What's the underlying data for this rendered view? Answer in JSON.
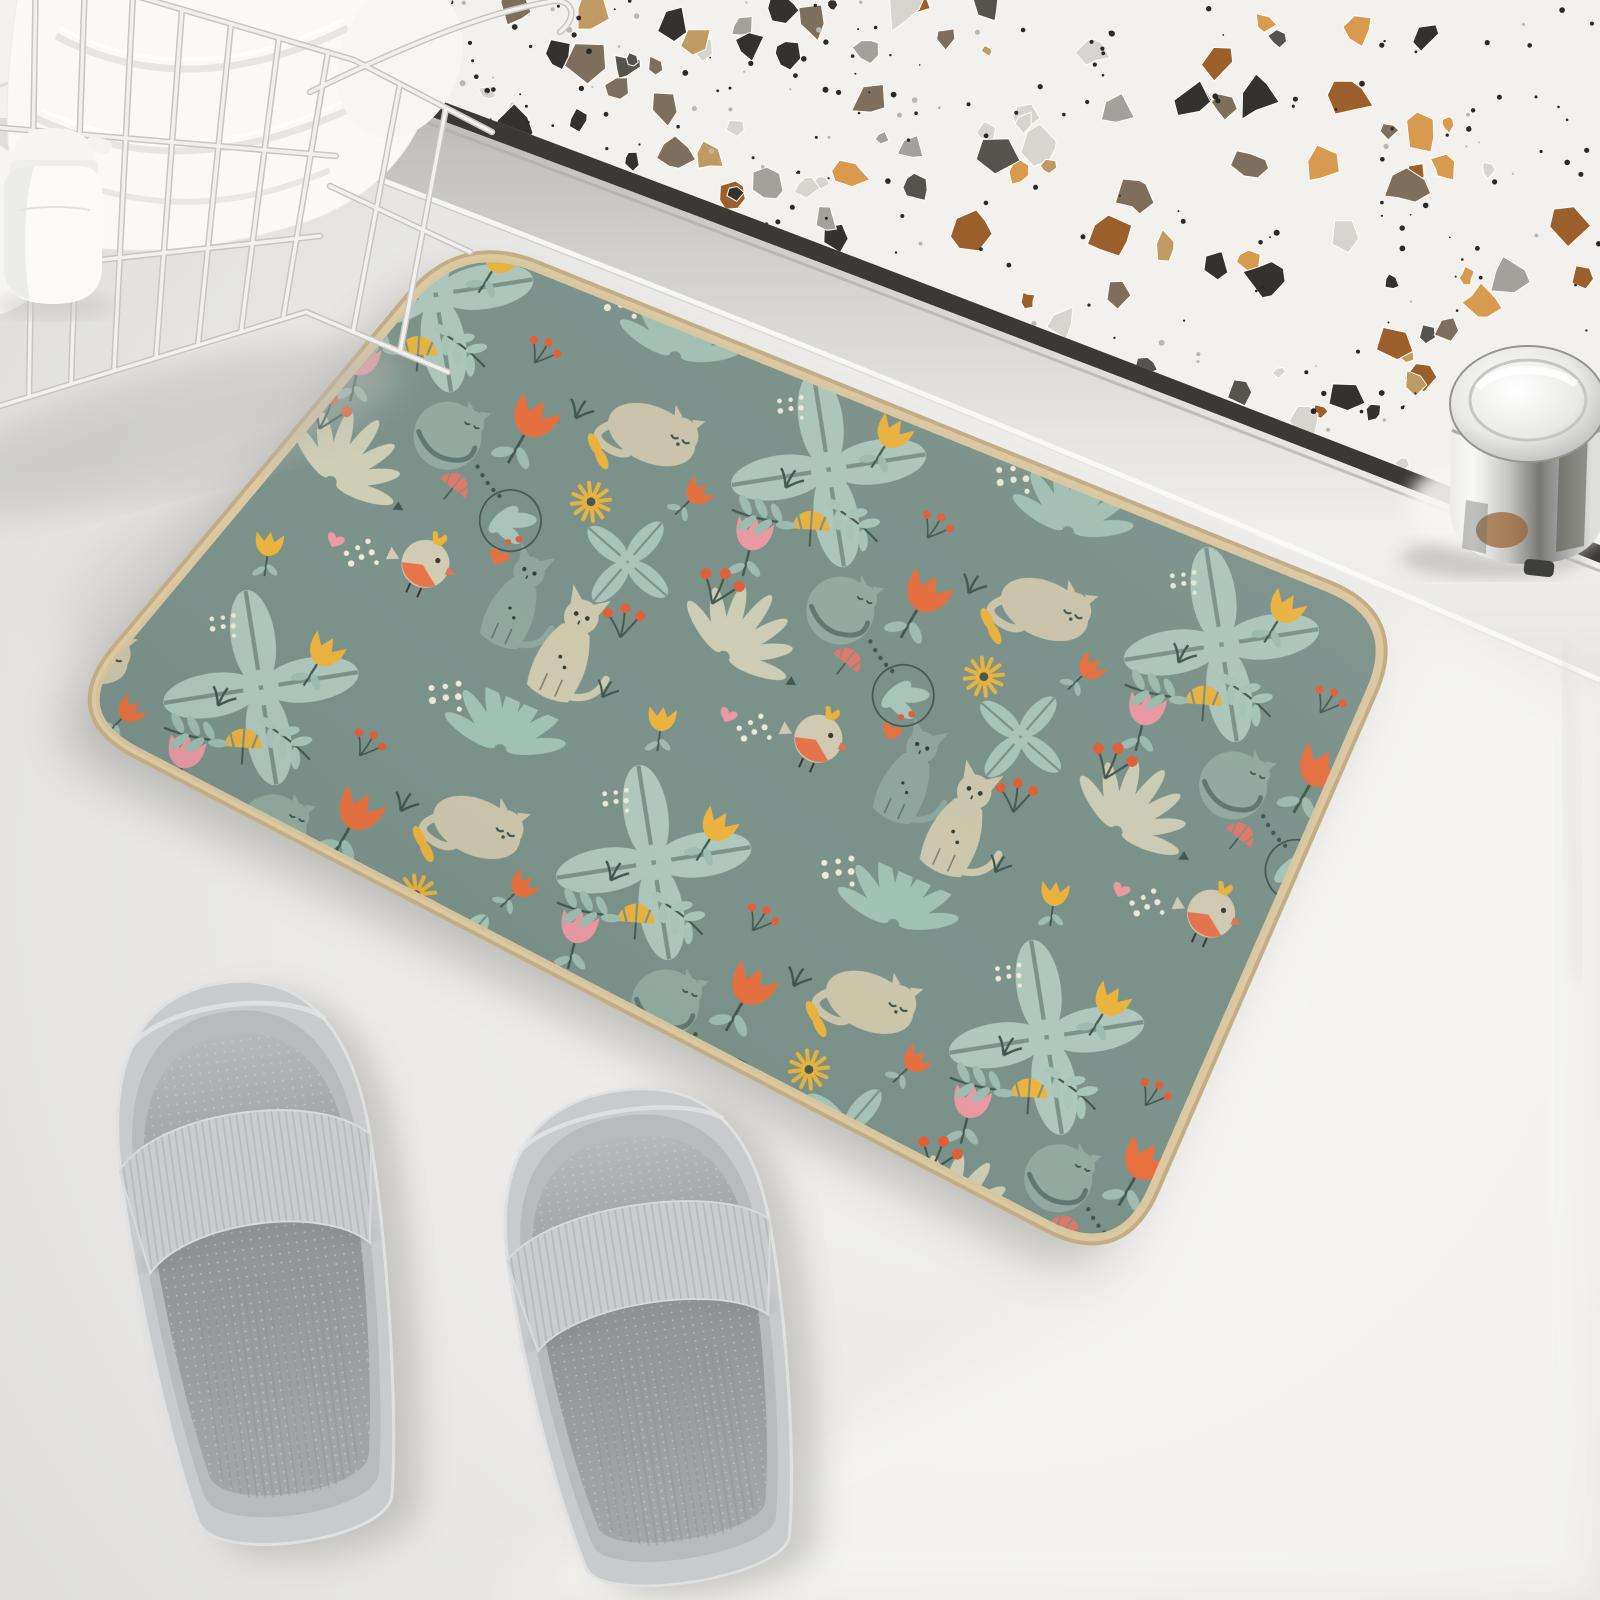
{
  "meta": {
    "kind": "product-photo",
    "width": 1600,
    "height": 1600
  },
  "palette": {
    "floor": "#EDECEA",
    "floor_bright": "#F6F5F3",
    "wall_tile": "#F3F2EF",
    "grout": "#DDDCD9",
    "terrazzo_base": "#F2F1EE",
    "groove": "#3B3936",
    "sill_dark": "#BDBCB9",
    "sill_light": "#F1F0ED",
    "knob_dark": "#3E3E3C",
    "mat_bg": "#7C938C",
    "mat_border": "#DCC9A2",
    "mat_border_dark": "#C3AD85",
    "leaf_light": "#AFC9BE",
    "leaf_mist": "#9FBDB2",
    "leaf_pale": "#CFCFB6",
    "dark_teal": "#44594F",
    "cat_cream": "#CFC9AE",
    "cat_green": "#8FA89F",
    "tulip_orange": "#E8703F",
    "tulip_yellow": "#ECB43E",
    "tulip_pink": "#EC9AA4",
    "berry_red": "#E2603A",
    "dot_cream": "#EDEAD9",
    "slipper_base": "#C9CACC",
    "slipper_mid": "#909194",
    "towel_white": "#FAF9F7",
    "bottle_white": "#FBFAF8",
    "basket_wire": "#F1F0EE"
  },
  "terrazzo": {
    "seed": 97,
    "chips": 110,
    "dots": 200,
    "chip_colors": [
      "#34322F",
      "#9B5F2C",
      "#D79A4F",
      "#A3A19C",
      "#D7D5D0",
      "#7E6F5C",
      "#C09A63",
      "#55534E"
    ],
    "dot_color": "#2A2926"
  },
  "objects": {
    "floor": {
      "label": "white bathroom floor"
    },
    "wall_tiles": {
      "label": "white tiled wall corner"
    },
    "basket": {
      "label": "white wire storage basket"
    },
    "towels": {
      "label": "folded white towels"
    },
    "bottle": {
      "label": "white flip-cap bottle"
    },
    "shower_panel": {
      "label": "white terrazzo speckled panel"
    },
    "sill": {
      "label": "aluminum door sill"
    },
    "knob": {
      "label": "chrome cylindrical knob"
    },
    "mat": {
      "label": "sage green cat and floral bath mat"
    },
    "slipper_left": {
      "label": "grey slide slipper"
    },
    "slipper_right": {
      "label": "grey slide slipper"
    }
  }
}
